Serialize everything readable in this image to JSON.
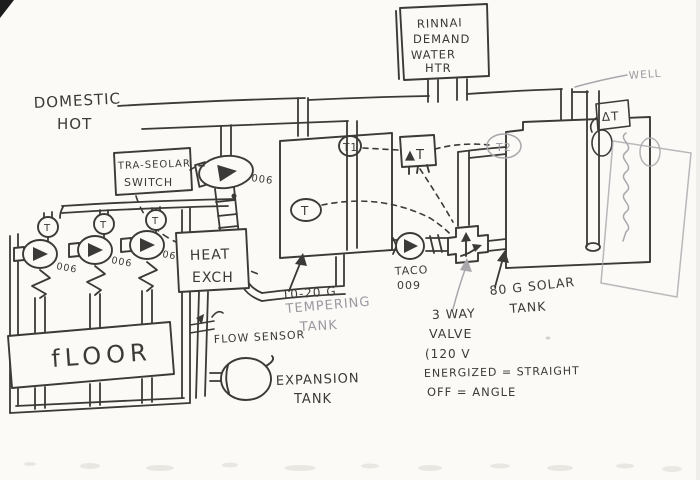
{
  "drawing": {
    "type": "hand-drawn plumbing schematic (pen on scanned paper)",
    "subject": "solar + tankless domestic hot water system with radiant floor loops"
  },
  "colors": {
    "ink": "#3c3a38",
    "pencil": "#9b99a0",
    "paper": "#fbfaf6"
  },
  "labels": {
    "heater": {
      "l1": "RINNAI",
      "l2": "DEMAND",
      "l3": "WATER",
      "l4": "HTR"
    },
    "domestic": {
      "l1": "DOMESTIC",
      "l2": "HOT"
    },
    "solar_switch": {
      "l1": "TRA-SEOLAR",
      "l2": "SWITCH"
    },
    "pump_top": "006",
    "heat_exch": {
      "l1": "HEAT",
      "l2": "EXCH"
    },
    "pump_labels": {
      "p1": "006",
      "p2": "006",
      "p3": "06"
    },
    "loop_sensors": {
      "s1": "T",
      "s2": "T",
      "s3": "T"
    },
    "floor": "fLOOR",
    "flow_sensor": "FLOW SENSOR",
    "expansion": {
      "l1": "EXPANSION",
      "l2": "TANK"
    },
    "tempering_size": "10-20 G",
    "tempering": {
      "l1": "TEMPERING",
      "l2": "TANK"
    },
    "tank_sensor": "T",
    "taco": {
      "l1": "TACO",
      "l2": "009"
    },
    "valve": {
      "l1": "3 WAY",
      "l2": "VALVE",
      "l3": "(120 V",
      "l4": "ENERGIZED = STRAIGHT",
      "l5": "OFF = ANGLE"
    },
    "solar_tank": {
      "l1": "80 G SOLAR",
      "l2": "TANK"
    },
    "sensors": {
      "t1": "T1",
      "t2": "T2",
      "dt_mid": "▲T",
      "dt_top": "ΔT"
    },
    "well": "WELL"
  }
}
